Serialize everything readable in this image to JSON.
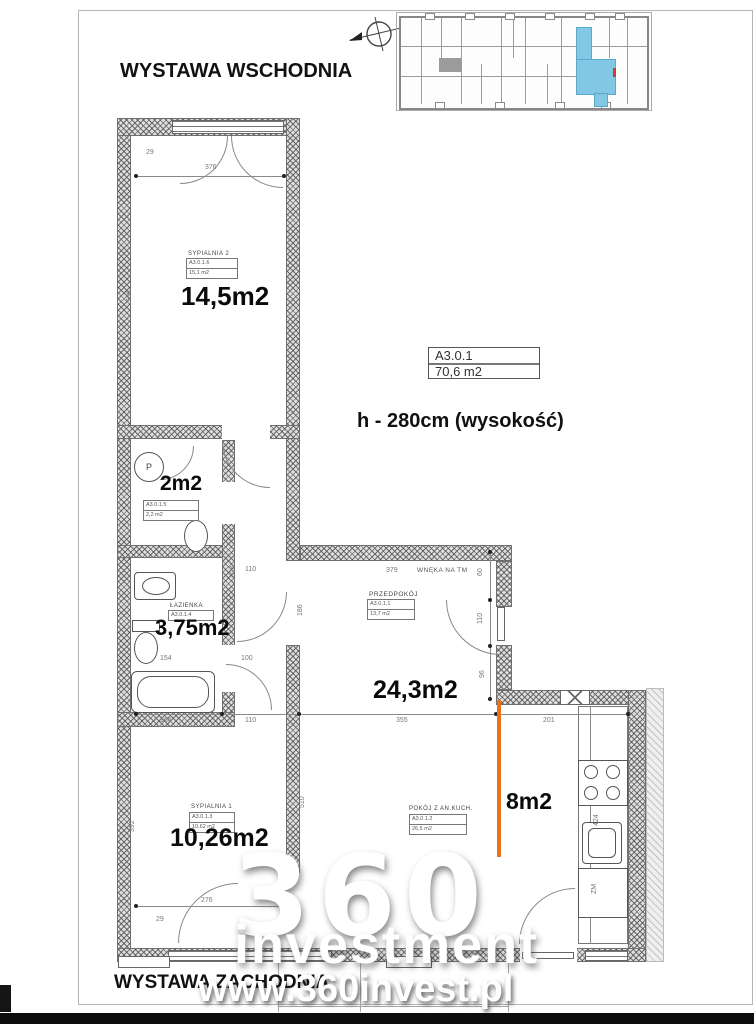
{
  "page": {
    "exposure_top": "WYSTAWA WSCHODNIA",
    "exposure_bottom": "WYSTAWA ZACHODNIA"
  },
  "unit": {
    "code": "A3.0.1",
    "total_area": "70,6 m2",
    "height_note": "h - 280cm (wysokość)"
  },
  "watermark": {
    "big": "360",
    "brand": "investment",
    "url": "www.360invest.pl"
  },
  "rooms": [
    {
      "name": "SYPIALNIA 2",
      "code": "A3.0.1.6",
      "area_small": "15,1 m2",
      "area_big": "14,5m2"
    },
    {
      "name": "WC",
      "code": "A3.0.1.5",
      "area_small": "2,2 m2",
      "area_big": "2m2"
    },
    {
      "name": "ŁAZIENKA",
      "code": "A3.0.1.4",
      "area_small": "3,75 m2",
      "area_big": "3,75m2"
    },
    {
      "name": "PRZEDPOKÓJ",
      "code": "A3.0.1.1",
      "area_small": "13,7 m2",
      "area_big": "24,3m2"
    },
    {
      "name": "SYPIALNIA 1",
      "code": "A3.0.1.3",
      "area_small": "10,62 m2",
      "area_big": "10,26m2"
    },
    {
      "name": "POKÓJ Z AN.KUCH.",
      "code": "A3.0.1.2",
      "area_small": "26,5 m2",
      "area_big": "8m2"
    }
  ],
  "annotations": {
    "niche": "WNĘKA NA TM",
    "washer": "P"
  },
  "dimensions": [
    {
      "t": "29",
      "x": 146,
      "y": 149,
      "r": 0
    },
    {
      "t": "376",
      "x": 205,
      "y": 164,
      "r": 0
    },
    {
      "t": "536",
      "x": 126,
      "y": 302,
      "r": -90
    },
    {
      "t": "335",
      "x": 230,
      "y": 577,
      "r": -90
    },
    {
      "t": "110",
      "x": 245,
      "y": 566,
      "r": 0
    },
    {
      "t": "379",
      "x": 386,
      "y": 567,
      "r": 0
    },
    {
      "t": "60",
      "x": 477,
      "y": 576,
      "r": -90
    },
    {
      "t": "186",
      "x": 297,
      "y": 616,
      "r": -90
    },
    {
      "t": "110",
      "x": 477,
      "y": 624,
      "r": -90
    },
    {
      "t": "96",
      "x": 479,
      "y": 678,
      "r": -90
    },
    {
      "t": "154",
      "x": 160,
      "y": 655,
      "r": 0
    },
    {
      "t": "100",
      "x": 241,
      "y": 655,
      "r": 0
    },
    {
      "t": "166",
      "x": 160,
      "y": 717,
      "r": 0
    },
    {
      "t": "110",
      "x": 245,
      "y": 717,
      "r": 0
    },
    {
      "t": "355",
      "x": 396,
      "y": 717,
      "r": 0
    },
    {
      "t": "201",
      "x": 543,
      "y": 717,
      "r": 0
    },
    {
      "t": "392",
      "x": 129,
      "y": 832,
      "r": -90
    },
    {
      "t": "510",
      "x": 299,
      "y": 808,
      "r": -90
    },
    {
      "t": "424",
      "x": 593,
      "y": 826,
      "r": -90
    },
    {
      "t": "276",
      "x": 201,
      "y": 897,
      "r": 0
    },
    {
      "t": "29",
      "x": 156,
      "y": 916,
      "r": 0
    },
    {
      "t": "ZM",
      "x": 591,
      "y": 894,
      "r": -90
    }
  ],
  "colors": {
    "highlight_orange": "#e8731a",
    "miniplan_blue": "#82c7e3",
    "wall_gray": "#dedede"
  }
}
